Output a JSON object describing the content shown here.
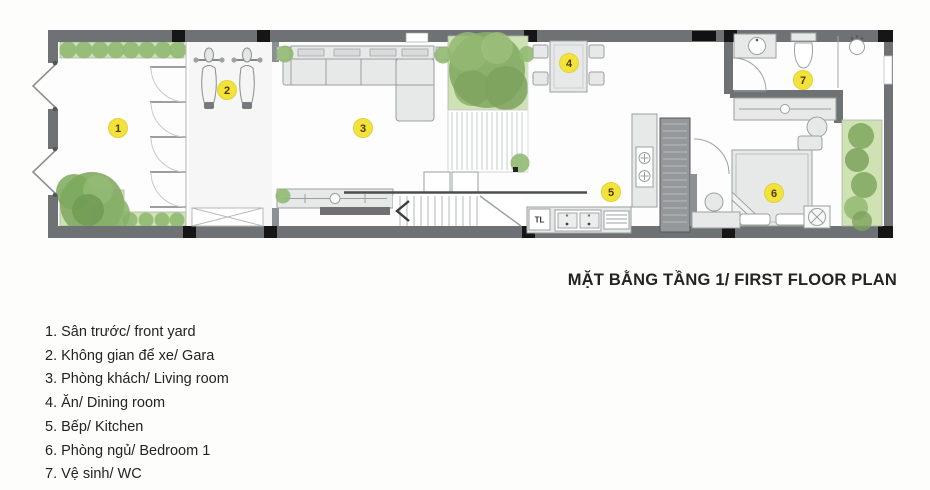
{
  "title": "MẶT BẰNG TẦNG 1/ FIRST FLOOR PLAN",
  "legend": {
    "items": [
      "1.  Sân trước/ front yard",
      "2.  Không gian để xe/ Gara",
      "3.  Phòng khách/ Living room",
      "4.  Ăn/ Dining room",
      "5.  Bếp/ Kitchen",
      "6.  Phòng ngủ/ Bedroom 1",
      "7.  Vệ sinh/ WC"
    ]
  },
  "plan": {
    "badges": [
      {
        "number": "1"
      },
      {
        "number": "2"
      },
      {
        "number": "3"
      },
      {
        "number": "4"
      },
      {
        "number": "5"
      },
      {
        "number": "6"
      },
      {
        "number": "7"
      }
    ],
    "fridge_label": "TL"
  },
  "theme": {
    "bg": "#fdfdfc",
    "wall": "#6f7274",
    "wall-light": "#8d9091",
    "column": "#161616",
    "floor": "#fdfdfd",
    "furn-fill": "#e7e9e8",
    "furn-stroke": "#9aa0a0",
    "green-light": "#cfe2b4",
    "green-mid": "#8fb870",
    "green-dark": "#86ab66",
    "badge": "#f3e23a",
    "badge-text": "#4a3c05",
    "text": "#232323"
  }
}
